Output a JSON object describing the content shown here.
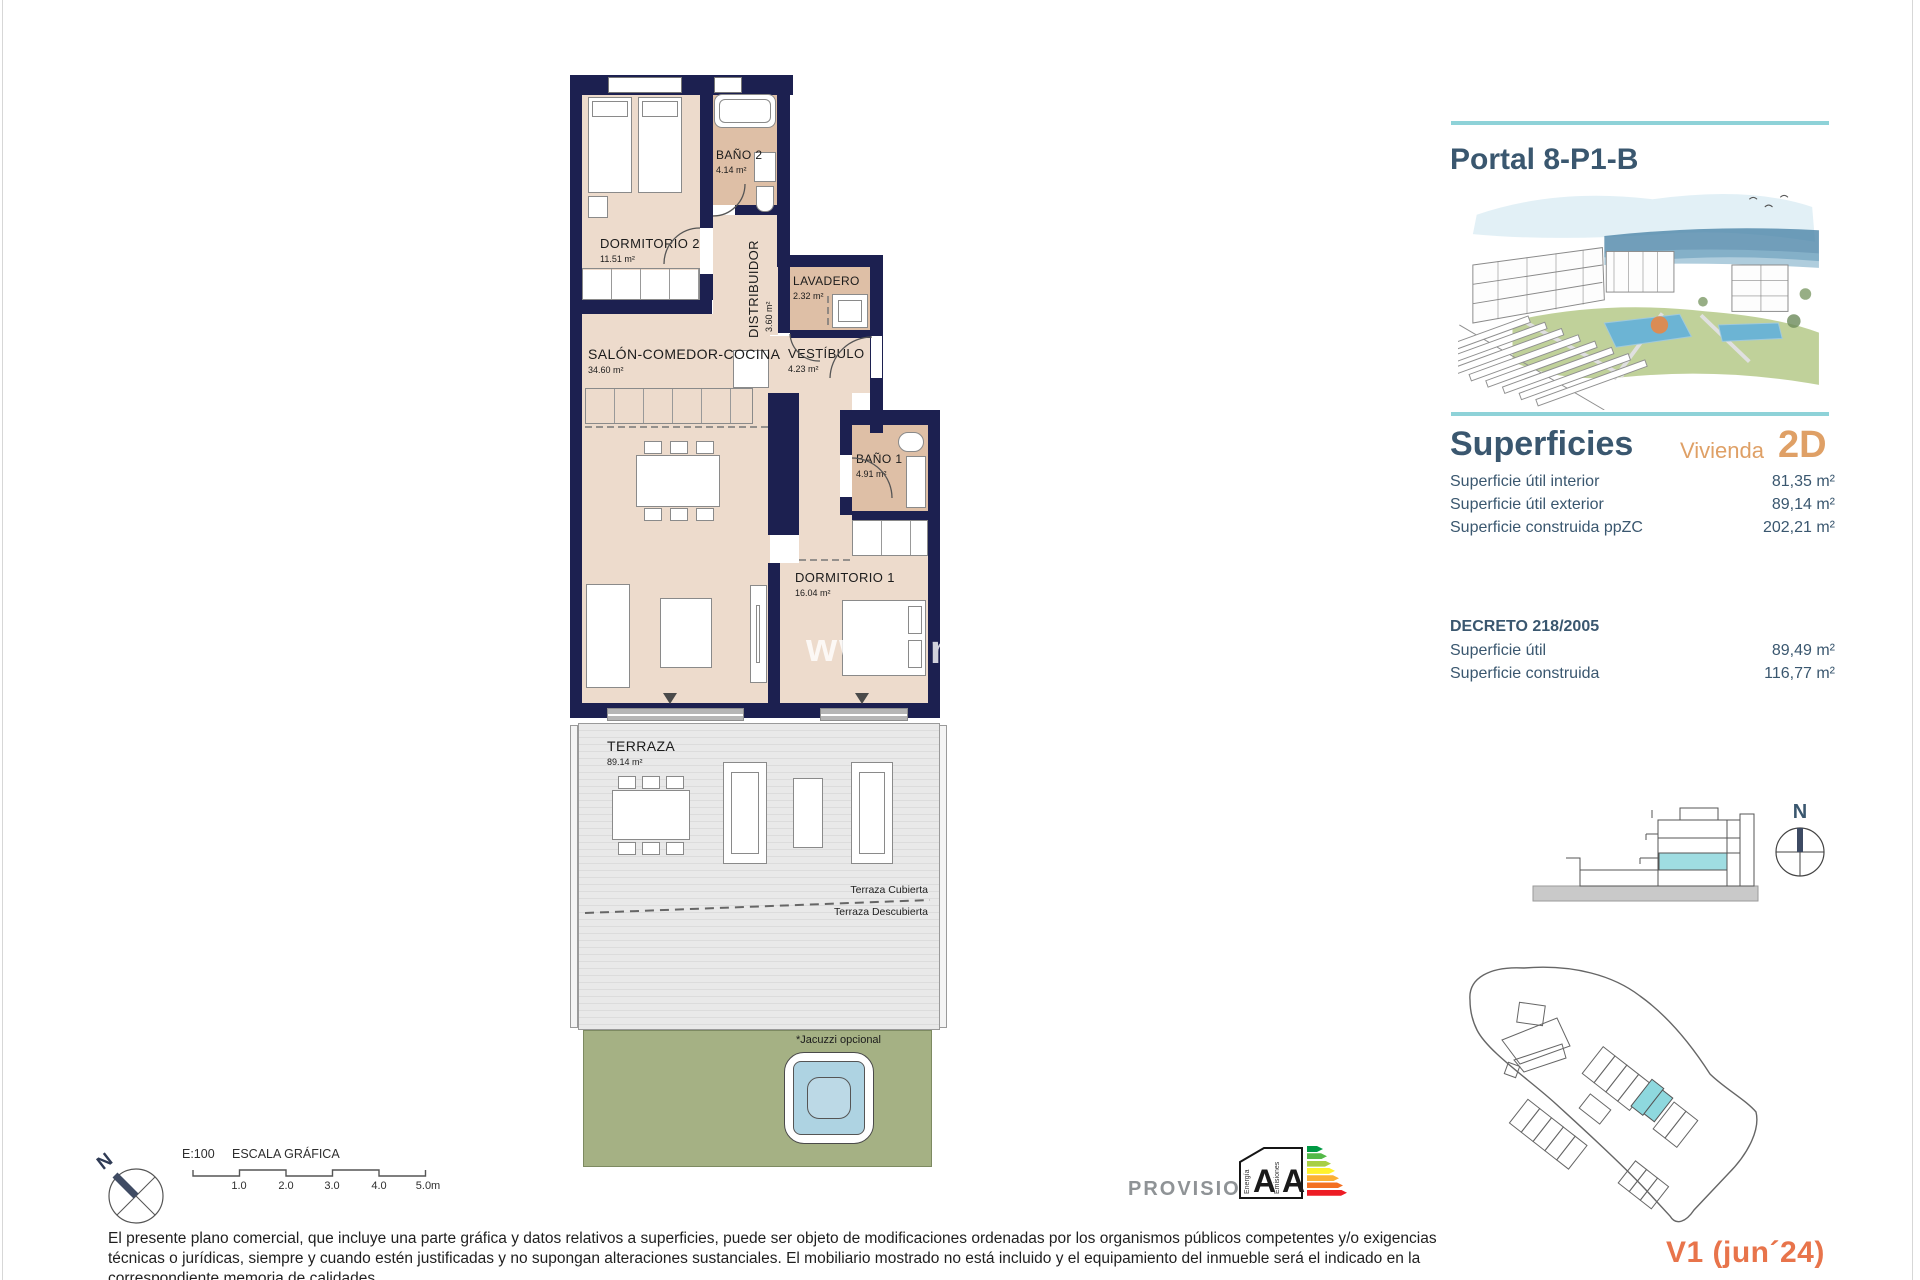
{
  "colors": {
    "navy": "#1c2050",
    "beige": "#eddbcc",
    "tan": "#debfa6",
    "teal": "#8ed2d8",
    "slate": "#3a576f",
    "orange": "#dfa066",
    "coral": "#e8744b",
    "green": "#a5b184",
    "pool": "#aed3e2",
    "cyan_highlight": "#8ed8de"
  },
  "floor_plan": {
    "watermark_left": "www",
    "watermark_right": "m",
    "rooms": [
      {
        "name": "DORMITORIO 2",
        "area": "11.51 m²"
      },
      {
        "name": "BAÑO 2",
        "area": "4.14 m²"
      },
      {
        "name": "DISTRIBUIDOR",
        "area": "3.60 m²"
      },
      {
        "name": "LAVADERO",
        "area": "2.32 m²"
      },
      {
        "name": "SALÓN-COMEDOR-COCINA",
        "area": "34.60 m²"
      },
      {
        "name": "VESTÍBULO",
        "area": "4.23 m²"
      },
      {
        "name": "BAÑO 1",
        "area": "4.91 m²"
      },
      {
        "name": "DORMITORIO 1",
        "area": "16.04 m²"
      },
      {
        "name": "TERRAZA",
        "area": "89.14 m²"
      }
    ],
    "annotations": {
      "covered": "Terraza Cubierta",
      "uncovered": "Terraza Descubierta",
      "jacuzzi": "*Jacuzzi opcional"
    }
  },
  "sidebar": {
    "title": "Portal 8-P1-B",
    "surfaces": {
      "heading": "Superficies",
      "unit_label": "Vivienda",
      "unit_type": "2D",
      "rows": [
        {
          "label": "Superficie útil interior",
          "value": "81,35 m²"
        },
        {
          "label": "Superficie útil exterior",
          "value": "89,14 m²"
        },
        {
          "label": "Superficie construida ppZC",
          "value": "202,21 m²"
        }
      ]
    },
    "decreto": {
      "heading": "DECRETO 218/2005",
      "rows": [
        {
          "label": "Superficie útil",
          "value": "89,49 m²"
        },
        {
          "label": "Superficie construida",
          "value": "116,77 m²"
        }
      ]
    },
    "section_compass": "N",
    "version": "V1 (jun´24)"
  },
  "footer": {
    "compass": "N",
    "scale": {
      "ratio": "E:100",
      "label": "ESCALA GRÁFICA",
      "ticks": [
        "1.0",
        "2.0",
        "3.0",
        "4.0",
        "5.0m"
      ]
    },
    "provisional": "PROVISIONAL",
    "energy": {
      "left_label": "Energía",
      "right_label": "Emisiones",
      "letter_left": "A",
      "letter_right": "A",
      "arrow_colors": [
        "#009a44",
        "#54b948",
        "#a8cf45",
        "#fff12c",
        "#fbb034",
        "#f37021",
        "#ed1c24"
      ]
    },
    "disclaimer_lines": [
      "El presente plano comercial, que incluye una parte gráfica y datos relativos a superficies, puede ser objeto de modificaciones ordenadas por los organismos públicos competentes y/o exigencias",
      "técnicas o jurídicas, siempre y cuando estén justificadas y no supongan alteraciones sustanciales. El mobiliario mostrado no está incluido y el equipamiento del inmueble será el indicado en la",
      "correspondiente memoria de calidades."
    ]
  }
}
